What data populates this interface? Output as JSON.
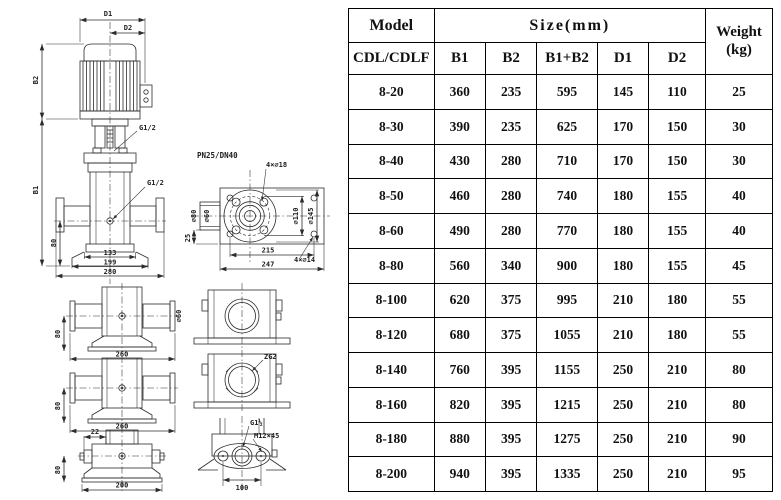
{
  "diagram": {
    "main_view": {
      "d1": "D1",
      "d2": "D2",
      "b2": "B2",
      "b1": "B1",
      "g12_top": "G1/2",
      "g12_mid": "G1/2",
      "dim_80": "80",
      "dim_133": "133",
      "dim_199": "199",
      "dim_280": "280"
    },
    "flange_view": {
      "rating": "PN25/DN40",
      "bolt_holes": "4×⌀18",
      "phi_80": "⌀80",
      "phi_60": "⌀60",
      "phi_110": "⌀110",
      "phi_145": "⌀145",
      "dim_25": "25",
      "dim_215": "215",
      "dim_247": "247",
      "base_holes": "4×⌀14"
    },
    "base_view_1": {
      "dim_80": "80",
      "dim_260": "260",
      "phi_60": "⌀60"
    },
    "base_view_2": {
      "dim_80": "80",
      "dim_260": "260"
    },
    "base_view_3": {
      "dim_22": "22",
      "dim_80": "80",
      "dim_200": "200"
    },
    "port_view_2": {
      "thread": "ZG2"
    },
    "port_view_3": {
      "thread": "G1½",
      "bolt": "M12×45",
      "dim_100": "100"
    }
  },
  "table": {
    "header": {
      "model": "Model",
      "model_sub": "CDL/CDLF",
      "size_group": "Size(mm)",
      "size_cols": [
        "B1",
        "B2",
        "B1+B2",
        "D1",
        "D2"
      ],
      "weight_line1": "Weight",
      "weight_line2": "(kg)"
    },
    "rows": [
      [
        "8-20",
        "360",
        "235",
        "595",
        "145",
        "110",
        "25"
      ],
      [
        "8-30",
        "390",
        "235",
        "625",
        "170",
        "150",
        "30"
      ],
      [
        "8-40",
        "430",
        "280",
        "710",
        "170",
        "150",
        "30"
      ],
      [
        "8-50",
        "460",
        "280",
        "740",
        "180",
        "155",
        "40"
      ],
      [
        "8-60",
        "490",
        "280",
        "770",
        "180",
        "155",
        "40"
      ],
      [
        "8-80",
        "560",
        "340",
        "900",
        "180",
        "155",
        "45"
      ],
      [
        "8-100",
        "620",
        "375",
        "995",
        "210",
        "180",
        "55"
      ],
      [
        "8-120",
        "680",
        "375",
        "1055",
        "210",
        "180",
        "55"
      ],
      [
        "8-140",
        "760",
        "395",
        "1155",
        "250",
        "210",
        "80"
      ],
      [
        "8-160",
        "820",
        "395",
        "1215",
        "250",
        "210",
        "80"
      ],
      [
        "8-180",
        "880",
        "395",
        "1275",
        "250",
        "210",
        "90"
      ],
      [
        "8-200",
        "940",
        "395",
        "1335",
        "250",
        "210",
        "95"
      ]
    ]
  },
  "colors": {
    "line": "#2b2b2b",
    "text": "#111111",
    "border": "#000000",
    "background": "#ffffff"
  }
}
